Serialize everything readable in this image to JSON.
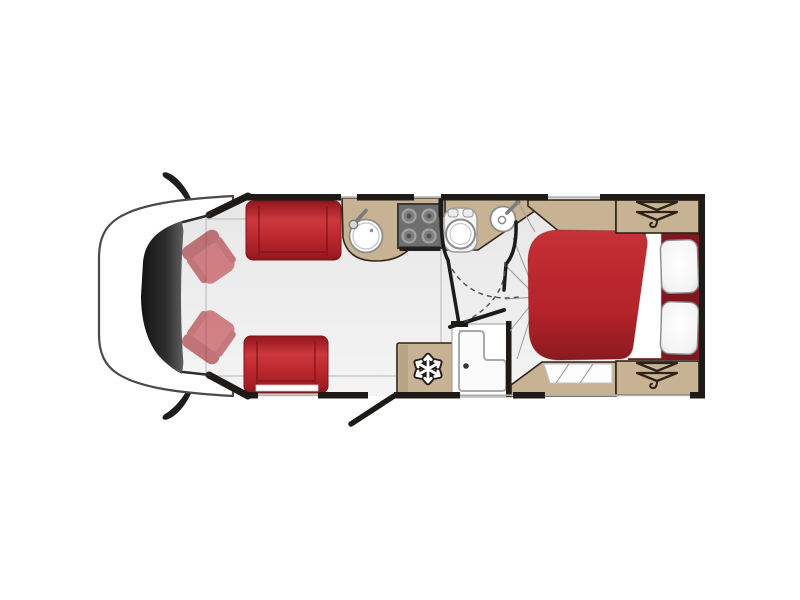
{
  "scene": "motorhome-floorplan-top-view",
  "areas": [
    "cab",
    "lounge",
    "kitchen",
    "washroom",
    "bedroom"
  ],
  "furniture": [
    "cab-seat-top",
    "cab-seat-bottom",
    "lounge-sofa-top",
    "lounge-seat-bottom",
    "kitchen-sink",
    "hob",
    "toilet",
    "washbasin",
    "shower",
    "fridge",
    "entry-door",
    "double-bed",
    "pillow-top",
    "pillow-bottom",
    "wardrobe-top",
    "wardrobe-bottom"
  ],
  "icons": {
    "fridge": "snowflake-icon",
    "wardrobe_top": "clothes-hanger-icon",
    "wardrobe_bottom": "clothes-hanger-icon"
  },
  "colors": {
    "background": "#ffffff",
    "floor": "#ebebeb",
    "floor_light": "#f4f4f4",
    "wall": "#1d1a17",
    "upholstery_red": "#bf2a2f",
    "upholstery_red_dark": "#8a161b",
    "duvet_red": "#b8262c",
    "headboard_maroon": "#7c191f",
    "worktop_tan": "#c8b294",
    "furniture_outline": "#2e2317",
    "hob_grey": "#6e6e6e",
    "fixture_outline": "#8c8c8c",
    "window_line": "#b0b0b0",
    "fold_line": "#9a9a9a",
    "windscreen_dark": "#1a1a1a",
    "cab_outline": "#4a4a4a",
    "cab_seat_red": "#bd383e"
  }
}
